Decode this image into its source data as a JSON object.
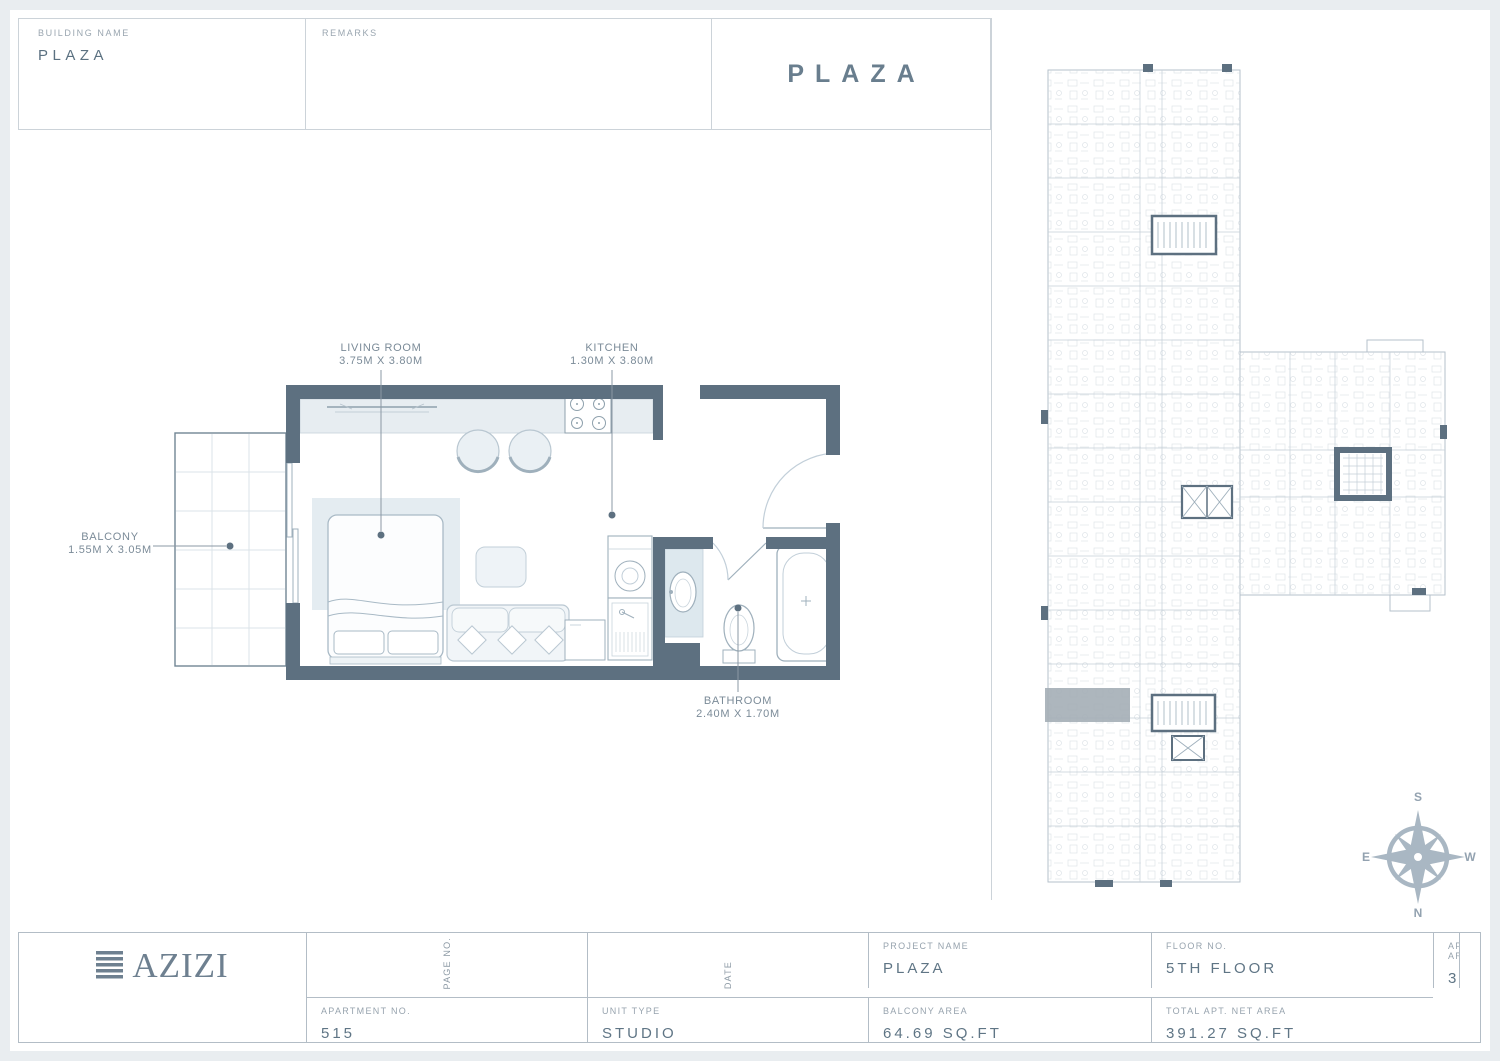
{
  "header": {
    "building_name_label": "BUILDING NAME",
    "building_name_value": "PLAZA",
    "remarks_label": "REMARKS",
    "sheet_title": "PLAZA"
  },
  "floor_plan": {
    "living_room_name": "LIVING ROOM",
    "living_room_dims": "3.75M X 3.80M",
    "kitchen_name": "KITCHEN",
    "kitchen_dims": "1.30M X 3.80M",
    "balcony_name": "BALCONY",
    "balcony_dims": "1.55M X 3.05M",
    "bathroom_name": "BATHROOM",
    "bathroom_dims": "2.40M X 1.70M"
  },
  "overview": {
    "compass": {
      "s": "S",
      "n": "N",
      "e": "E",
      "w": "W"
    }
  },
  "footer": {
    "logo_text": "AZIZI",
    "project_name_label": "PROJECT NAME",
    "project_name_value": "PLAZA",
    "floor_no_label": "FLOOR NO.",
    "floor_no_value": "5TH FLOOR",
    "apt_area_label": "APT. AREA",
    "apt_area_value": "326.58 SQ.FT",
    "apartment_no_label": "APARTMENT NO.",
    "apartment_no_value": "515",
    "unit_type_label": "UNIT TYPE",
    "unit_type_value": "STUDIO",
    "balcony_area_label": "BALCONY AREA",
    "balcony_area_value": "64.69 SQ.FT",
    "total_area_label": "TOTAL APT. NET AREA",
    "total_area_value": "391.27 SQ.FT",
    "page_no_label": "PAGE NO.",
    "date_label": "DATE"
  },
  "colors": {
    "wall": "#5d7080",
    "counter_fill": "#e7edf1",
    "highlight_unit": "#a4aeb6",
    "compass": "#a9b7c3"
  }
}
